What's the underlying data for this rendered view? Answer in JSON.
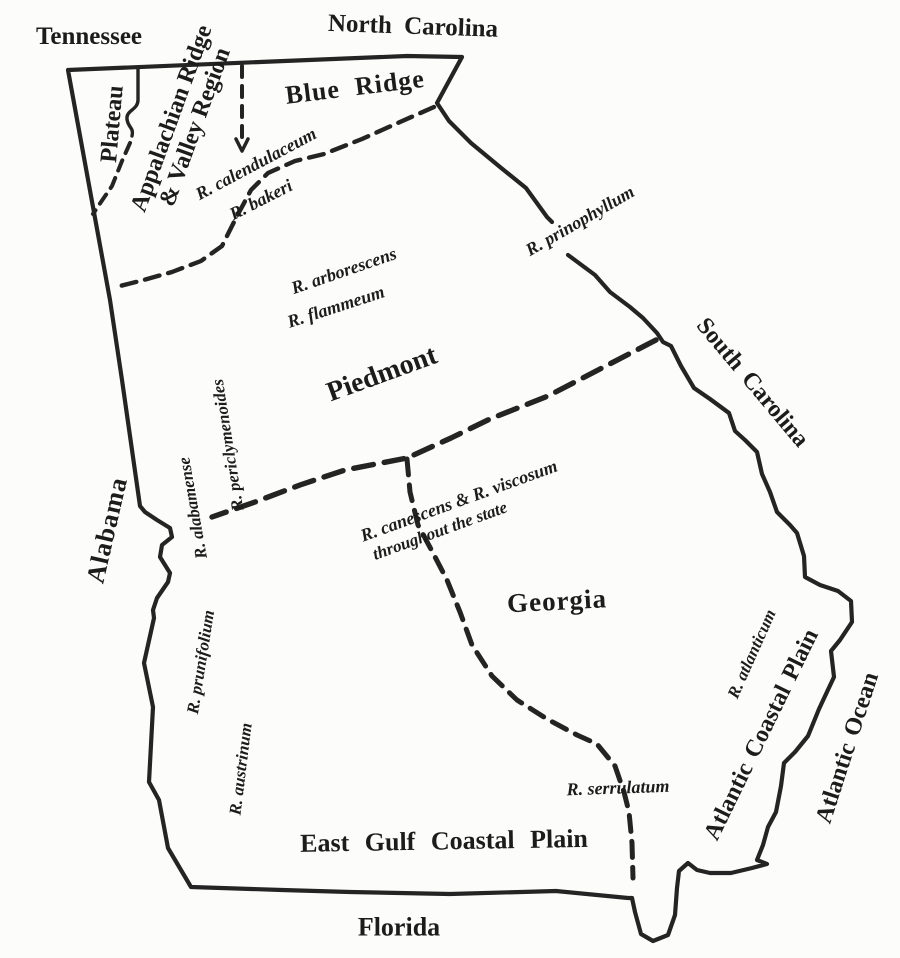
{
  "canvas": {
    "background": "#fcfcfa",
    "ink": "#242424"
  },
  "neighbor_states": {
    "tennessee": "Tennessee",
    "north_carolina": "North Carolina",
    "south_carolina": "South Carolina",
    "alabama": "Alabama",
    "florida": "Florida"
  },
  "state_label": "Georgia",
  "ocean_label": "Atlantic Ocean",
  "physiographic_regions": {
    "plateau": "Plateau",
    "ridge_valley": {
      "line1": "Appalachian Ridge",
      "line2": "& Valley Region"
    },
    "blue_ridge": "Blue Ridge",
    "piedmont": "Piedmont",
    "east_gulf_coastal_plain": "East Gulf Coastal Plain",
    "atlantic_coastal_plain": "Atlantic Coastal Plain"
  },
  "species_annotations": {
    "calendulaceum": "R. calendulaceum",
    "bakeri": "R. bakeri",
    "arborescens": "R. arborescens",
    "flammeum": "R. flammeum",
    "prinophyllum": "R. prinophyllum",
    "periclymenoides": "R. periclymenoides",
    "alabamense": "R. alabamense",
    "canescens_viscosum": {
      "line1": "R. canescens & R. viscosum",
      "line2": "throughout the state"
    },
    "prunifolium": "R. prunifolium",
    "austrinum": "R. austrinum",
    "atlanticum": "R. atlanticum",
    "serrulatum": "R. serrulatum"
  }
}
